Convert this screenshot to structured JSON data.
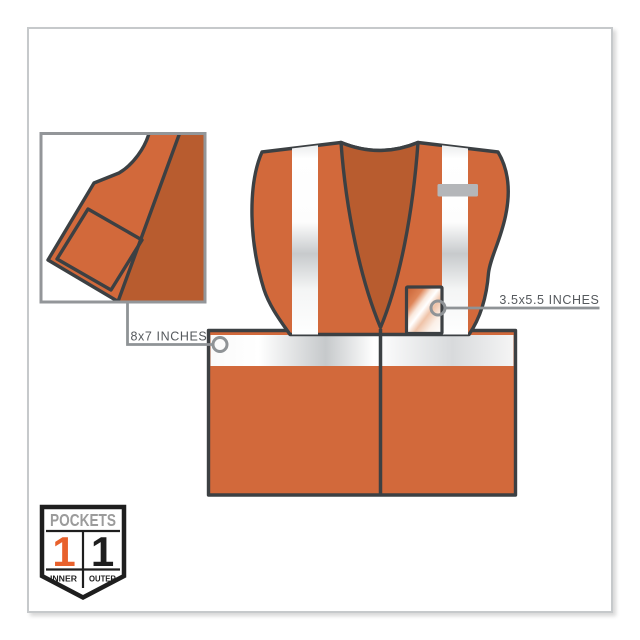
{
  "callouts": {
    "inner_pocket": {
      "label": "8x7 INCHES"
    },
    "id_pocket": {
      "label": "3.5x5.5 INCHES"
    }
  },
  "badge": {
    "title": "POCKETS",
    "inner_count": "1",
    "outer_count": "1",
    "inner_label": "INNER",
    "outer_label": "OUTER"
  },
  "colors": {
    "vest_orange": "#D2693B",
    "vest_shadow_orange": "#B85C2F",
    "outline": "#3C4043",
    "reflective_silver": "#C9CCCE",
    "callout_line": "#8F9396",
    "label_text": "#55595D",
    "badge_orange": "#E8612C",
    "badge_black": "#1E1E1E",
    "badge_title_gray": "#9B9B9B",
    "frame_border": "#C6C9CB",
    "mic_tab_gray": "#B4B6B9"
  }
}
